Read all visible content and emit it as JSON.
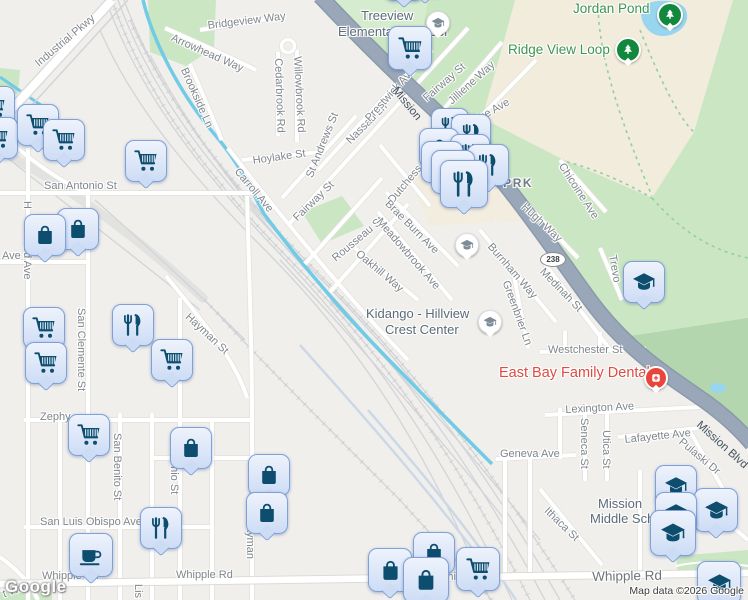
{
  "attribution": {
    "logo": "Google",
    "map_data": "Map data ©2026 Google"
  },
  "colors": {
    "pin_fill": "#dce8f9",
    "pin_border": "#7fa0d8",
    "pin_glyph": "#0d4d6d",
    "pin_slat": "#dbe7f8",
    "school_glyph": "#7d8c98",
    "park_pin": "#12873e",
    "dental_red": "#e8453c",
    "highway": "#9aa7b8",
    "creek": "#71cbe7",
    "park_fill": "#cbe6c3",
    "terrain_tan": "#f1ecdc",
    "park_label": "#3d9552",
    "street_label": "#7f868c",
    "poi_red_label": "#dd4b42"
  },
  "map": {
    "labels": [
      {
        "t": "Industrial Pkwy",
        "x": 33,
        "y": 60,
        "r": -40
      },
      {
        "t": "Bridgeview Way",
        "x": 207,
        "y": 20,
        "r": -7
      },
      {
        "t": "Arrowhead Way",
        "x": 174,
        "y": 32,
        "r": 24
      },
      {
        "t": "Brookside Ln",
        "x": 189,
        "y": 66,
        "r": 66
      },
      {
        "t": "Treeview",
        "x": 361,
        "y": 8,
        "c": "sch",
        "i": true
      },
      {
        "t": "Elementary School",
        "x": 338,
        "y": 24,
        "c": "sch",
        "i": true
      },
      {
        "t": "Willowbrook Rd",
        "x": 303,
        "y": 56,
        "r": 87
      },
      {
        "t": "Cedarbrook Rd",
        "x": 284,
        "y": 58,
        "r": 88
      },
      {
        "t": "St Andrews St",
        "x": 304,
        "y": 175,
        "r": -68
      },
      {
        "t": "Nassau Ln",
        "x": 344,
        "y": 138,
        "r": -45
      },
      {
        "t": "Prestwick Ave",
        "x": 363,
        "y": 116,
        "r": -48
      },
      {
        "t": "Fairway St",
        "x": 421,
        "y": 95,
        "r": -41
      },
      {
        "t": "Jilliene Way",
        "x": 446,
        "y": 98,
        "r": -42
      },
      {
        "t": "nice Ave",
        "x": 470,
        "y": 117,
        "r": -30
      },
      {
        "t": "Hoylake St",
        "x": 252,
        "y": 155,
        "r": -8
      },
      {
        "t": "Carroll Ave",
        "x": 241,
        "y": 166,
        "r": 50
      },
      {
        "t": "Fairway St",
        "x": 291,
        "y": 215,
        "r": -44
      },
      {
        "t": "Mission",
        "x": 399,
        "y": 85,
        "r": 51,
        "c": "hwy"
      },
      {
        "t": "Dutchess",
        "x": 386,
        "y": 198,
        "r": -50
      },
      {
        "t": "Rousseau St",
        "x": 330,
        "y": 255,
        "r": -40
      },
      {
        "t": "Oakhill Way",
        "x": 361,
        "y": 248,
        "r": 40
      },
      {
        "t": "Meadowbrook Ave",
        "x": 383,
        "y": 216,
        "r": 49
      },
      {
        "t": "Brae Burn Ave",
        "x": 391,
        "y": 198,
        "r": 45
      },
      {
        "t": "San Antonio St",
        "x": 44,
        "y": 180
      },
      {
        "t": "Ave",
        "x": 2,
        "y": 250
      },
      {
        "t": "H",
        "x": 33,
        "y": 201,
        "r": 90
      },
      {
        "t": "od Ave",
        "x": 33,
        "y": 246,
        "r": 90
      },
      {
        "t": "San Clemente St",
        "x": 87,
        "y": 308,
        "r": 90
      },
      {
        "t": "Hayman St",
        "x": 191,
        "y": 311,
        "r": 43
      },
      {
        "t": "Zephy",
        "x": 40,
        "y": 411
      },
      {
        "t": "San Benito St",
        "x": 123,
        "y": 433,
        "r": 90
      },
      {
        "t": "onio St",
        "x": 180,
        "y": 460,
        "r": 90
      },
      {
        "t": "San Luis Obispo Ave",
        "x": 40,
        "y": 516
      },
      {
        "t": "Whipple Rd",
        "x": 42,
        "y": 570
      },
      {
        "t": "Whipple Rd",
        "x": 176,
        "y": 569
      },
      {
        "t": "Whipple Rd",
        "x": 437,
        "y": 571
      },
      {
        "t": "Whipple Rd",
        "x": 592,
        "y": 569,
        "r": -1,
        "c": "maj"
      },
      {
        "t": "Hayman",
        "x": 256,
        "y": 518,
        "r": 90
      },
      {
        "t": "Lis",
        "x": 144,
        "y": 584,
        "r": 90
      },
      {
        "t": "t Way",
        "x": 1,
        "y": 589,
        "r": -20
      },
      {
        "t": "Lexington Ave",
        "x": 565,
        "y": 404,
        "r": -3
      },
      {
        "t": "Seneca St",
        "x": 590,
        "y": 418,
        "r": 90
      },
      {
        "t": "Utica St",
        "x": 612,
        "y": 430,
        "r": 90
      },
      {
        "t": "Lafayette Ave",
        "x": 624,
        "y": 434,
        "r": -6
      },
      {
        "t": "Pulaski Dr",
        "x": 684,
        "y": 436,
        "r": 40
      },
      {
        "t": "Mission Blvd",
        "x": 702,
        "y": 419,
        "r": 42,
        "c": "hwy"
      },
      {
        "t": "Geneva Ave",
        "x": 500,
        "y": 448
      },
      {
        "t": "Ithaca St",
        "x": 550,
        "y": 505,
        "r": 44
      },
      {
        "t": "Mission",
        "x": 598,
        "y": 496,
        "c": "sch",
        "i": true
      },
      {
        "t": "Middle School",
        "x": 590,
        "y": 511,
        "c": "sch",
        "i": true
      },
      {
        "t": "Westchester St",
        "x": 548,
        "y": 344
      },
      {
        "t": "East Bay Family Dental",
        "x": 499,
        "y": 365,
        "c": "red",
        "i": true
      },
      {
        "t": "Hugh Way",
        "x": 527,
        "y": 201,
        "r": 43
      },
      {
        "t": "Medinah St",
        "x": 546,
        "y": 266,
        "r": 46
      },
      {
        "t": "Burnham Way",
        "x": 494,
        "y": 241,
        "r": 49
      },
      {
        "t": "Greenbrier Ln",
        "x": 511,
        "y": 279,
        "r": 70
      },
      {
        "t": "Trevo",
        "x": 618,
        "y": 254,
        "r": 80
      },
      {
        "t": "Chicoine Ave",
        "x": 566,
        "y": 161,
        "r": 57
      },
      {
        "t": "AY PRK",
        "x": 480,
        "y": 176,
        "c": "prkbig",
        "i": true
      },
      {
        "t": "Jordan Pond",
        "x": 573,
        "y": 1,
        "c": "park",
        "i": true
      },
      {
        "t": "Ridge View Loop",
        "x": 508,
        "y": 42,
        "c": "park",
        "i": true
      },
      {
        "t": "Kidango - Hillview",
        "x": 366,
        "y": 306,
        "c": "sch",
        "i": true
      },
      {
        "t": "Crest Center",
        "x": 385,
        "y": 322,
        "c": "sch",
        "i": true
      }
    ],
    "markers": [
      {
        "k": "tip",
        "x": 403,
        "y": -20,
        "s": 38
      },
      {
        "k": "tip",
        "x": 424,
        "y": -24,
        "s": 38
      },
      {
        "k": "sch",
        "x": 437,
        "y": 22,
        "s": 22
      },
      {
        "k": "cart",
        "x": 409,
        "y": 47,
        "s": 42
      },
      {
        "k": "tree",
        "x": 668,
        "y": 13,
        "s": 22
      },
      {
        "k": "tree",
        "x": 626,
        "y": 48,
        "s": 22
      },
      {
        "k": "cart",
        "x": -7,
        "y": 106,
        "s": 40
      },
      {
        "k": "cart",
        "x": -4,
        "y": 137,
        "s": 40
      },
      {
        "k": "cart",
        "x": 37,
        "y": 124,
        "s": 40
      },
      {
        "k": "cart",
        "x": 63,
        "y": 139,
        "s": 40
      },
      {
        "k": "cart",
        "x": 145,
        "y": 160,
        "s": 40
      },
      {
        "k": "food",
        "x": 449,
        "y": 126,
        "s": 36
      },
      {
        "k": "food",
        "x": 470,
        "y": 133,
        "s": 38
      },
      {
        "k": "bag",
        "x": 438,
        "y": 147,
        "s": 38
      },
      {
        "k": "food",
        "x": 469,
        "y": 153,
        "s": 38
      },
      {
        "k": "bag",
        "x": 441,
        "y": 161,
        "s": 40
      },
      {
        "k": "food",
        "x": 487,
        "y": 164,
        "s": 40
      },
      {
        "k": "bag",
        "x": 452,
        "y": 171,
        "s": 42
      },
      {
        "k": "food",
        "x": 463,
        "y": 183,
        "s": 46
      },
      {
        "k": "bag",
        "x": 77,
        "y": 228,
        "s": 40
      },
      {
        "k": "bag",
        "x": 44,
        "y": 234,
        "s": 40
      },
      {
        "k": "shield",
        "x": 552,
        "y": 258,
        "t": "238"
      },
      {
        "k": "gradc",
        "x": 466,
        "y": 244,
        "s": 22
      },
      {
        "k": "grad",
        "x": 643,
        "y": 281,
        "s": 40
      },
      {
        "k": "gradc",
        "x": 489,
        "y": 321,
        "s": 22
      },
      {
        "k": "food",
        "x": 132,
        "y": 324,
        "s": 40
      },
      {
        "k": "cart",
        "x": 43,
        "y": 327,
        "s": 40
      },
      {
        "k": "cart",
        "x": 171,
        "y": 359,
        "s": 40
      },
      {
        "k": "cart",
        "x": 45,
        "y": 362,
        "s": 40
      },
      {
        "k": "med",
        "x": 654,
        "y": 376,
        "s": 20
      },
      {
        "k": "cart",
        "x": 88,
        "y": 434,
        "s": 40
      },
      {
        "k": "bag",
        "x": 190,
        "y": 447,
        "s": 40
      },
      {
        "k": "bag",
        "x": 268,
        "y": 474,
        "s": 40
      },
      {
        "k": "bag",
        "x": 266,
        "y": 512,
        "s": 40
      },
      {
        "k": "grad",
        "x": 675,
        "y": 485,
        "s": 40
      },
      {
        "k": "grad",
        "x": 715,
        "y": 509,
        "s": 42
      },
      {
        "k": "grad",
        "x": 675,
        "y": 512,
        "s": 40
      },
      {
        "k": "food",
        "x": 160,
        "y": 527,
        "s": 40
      },
      {
        "k": "grad",
        "x": 672,
        "y": 532,
        "s": 44
      },
      {
        "k": "bag",
        "x": 433,
        "y": 552,
        "s": 40
      },
      {
        "k": "coffee",
        "x": 90,
        "y": 554,
        "s": 42
      },
      {
        "k": "bag",
        "x": 389,
        "y": 569,
        "s": 42
      },
      {
        "k": "cart",
        "x": 477,
        "y": 568,
        "s": 42
      },
      {
        "k": "bag",
        "x": 425,
        "y": 579,
        "s": 44
      },
      {
        "k": "grad",
        "x": 718,
        "y": 582,
        "s": 42
      }
    ]
  }
}
